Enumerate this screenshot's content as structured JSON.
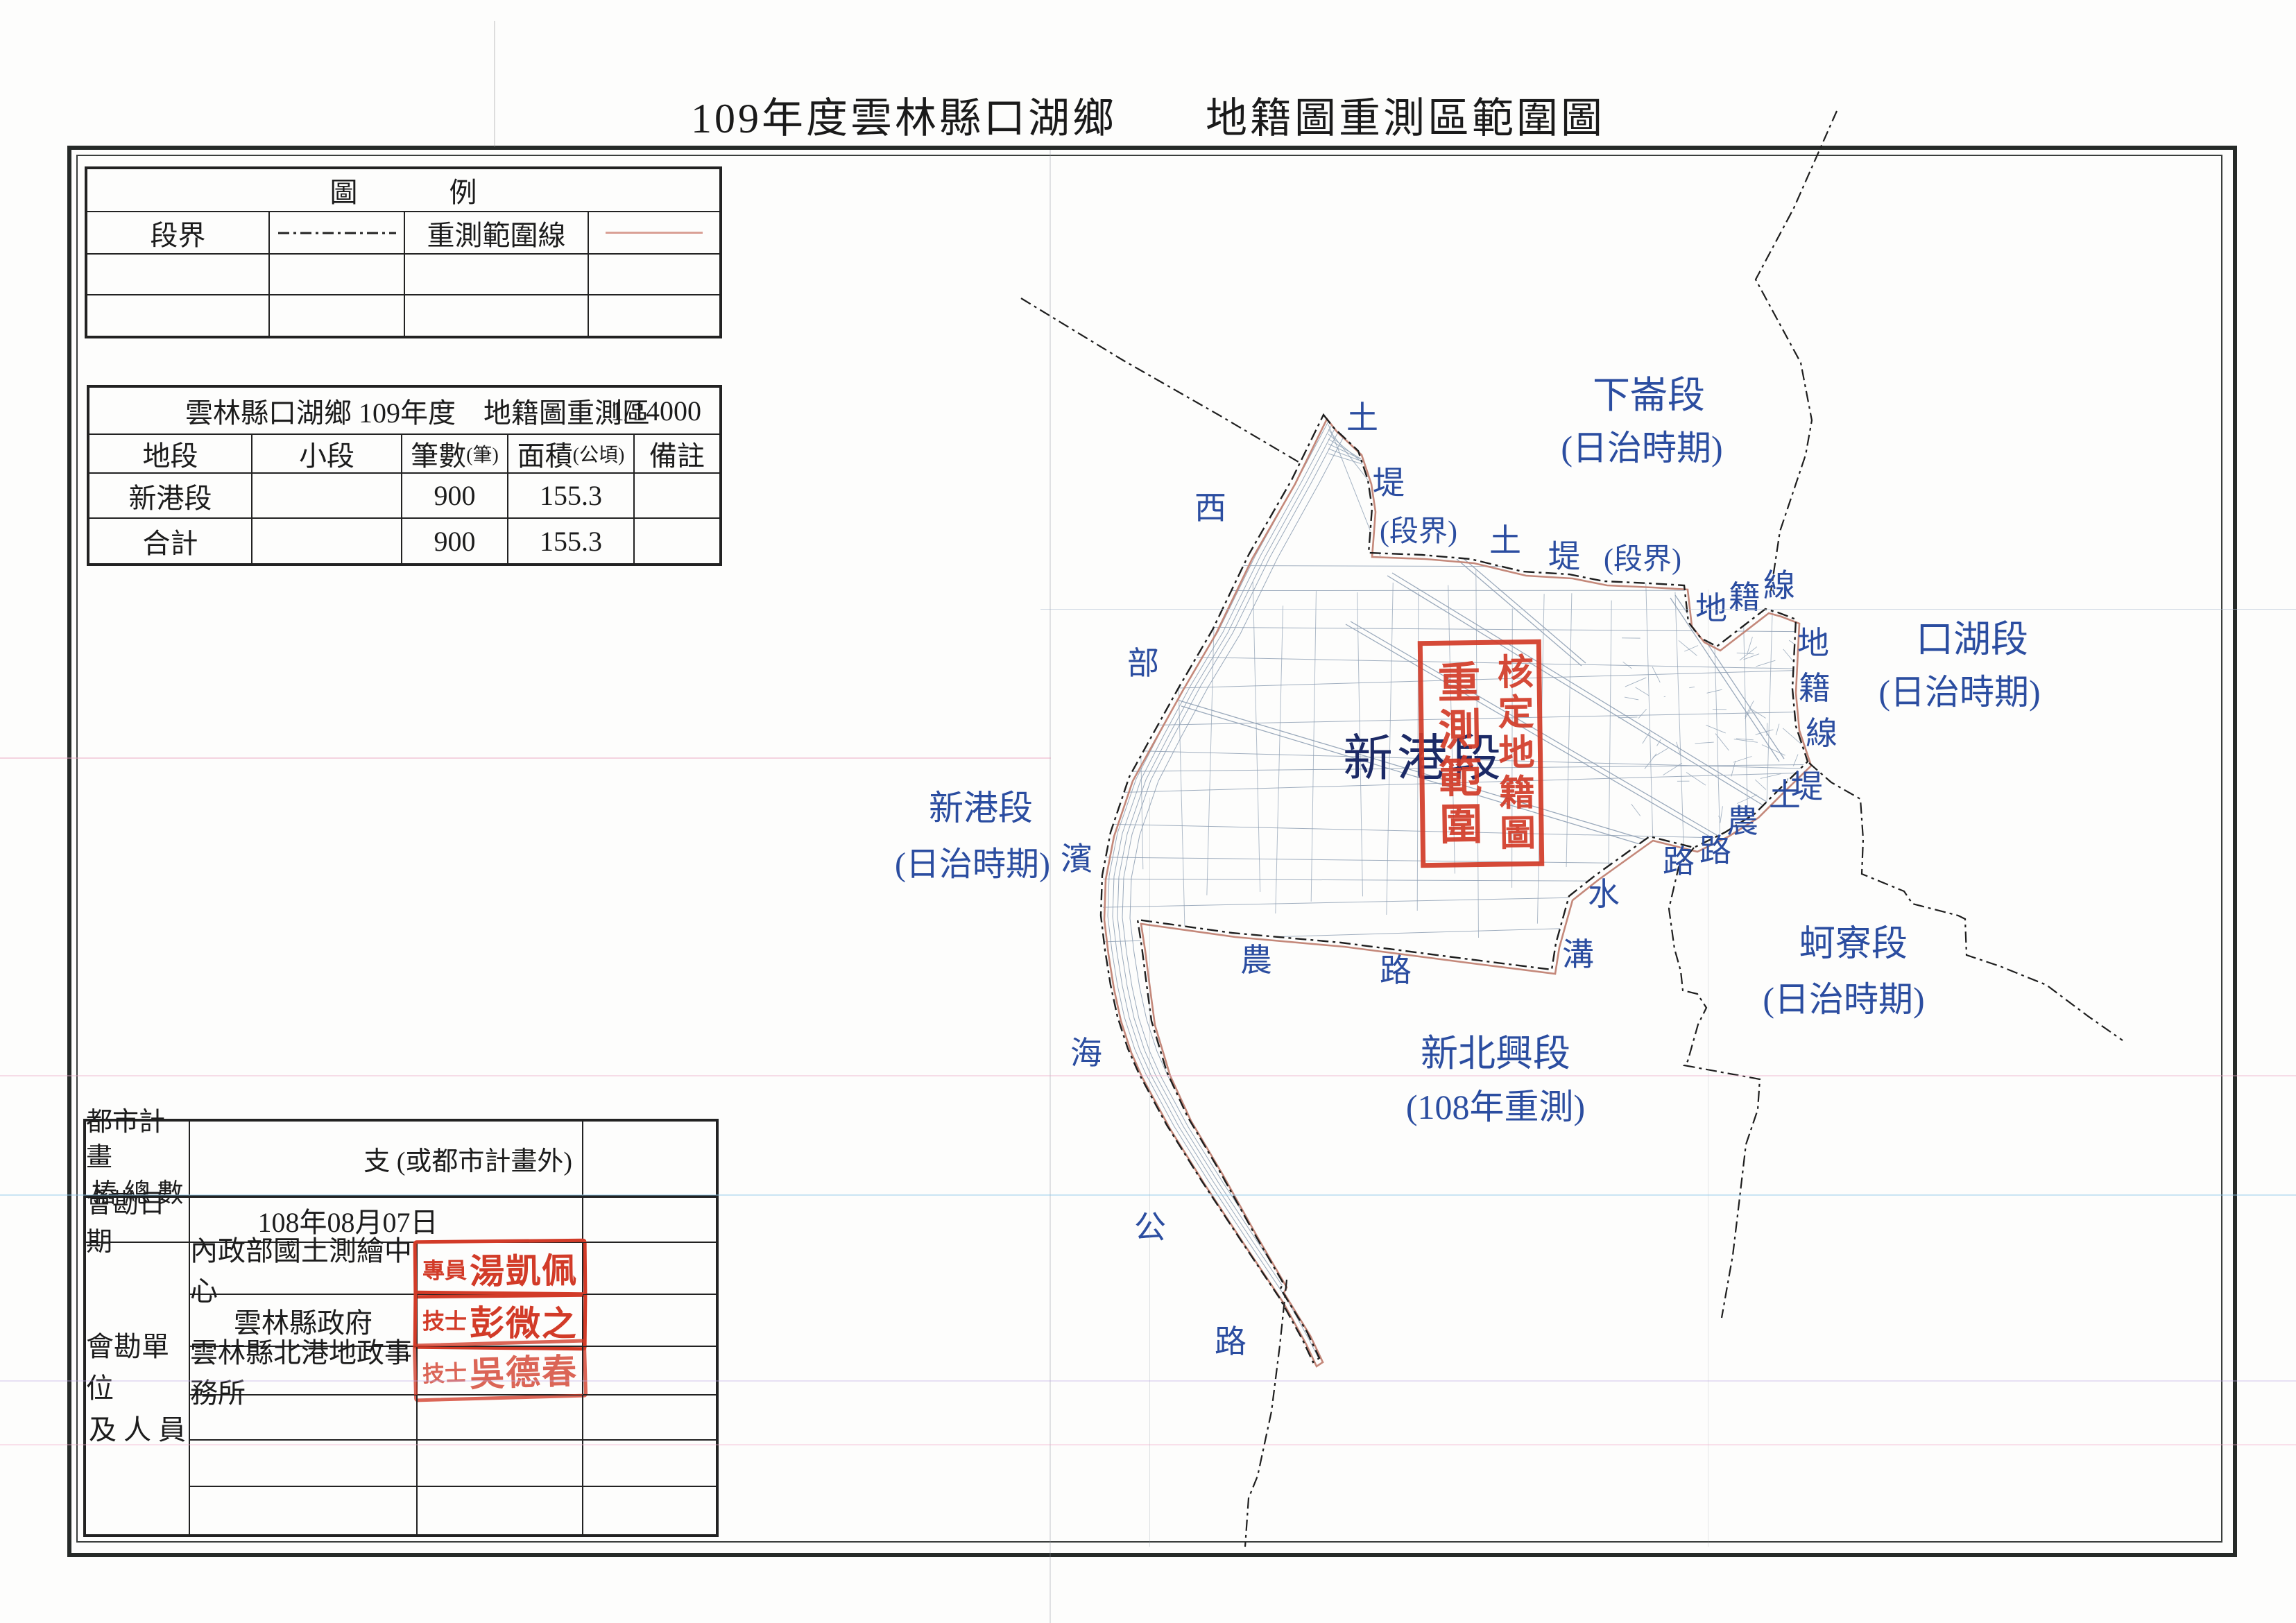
{
  "page": {
    "title": "109年度雲林縣口湖鄉　　地籍圖重測區範圍圖"
  },
  "colors": {
    "label_blue": "#2b4da0",
    "stamp_red": "#d23b28",
    "range_line_pink": "#d9a095",
    "boundary_black": "#1e1e1e"
  },
  "legend": {
    "header": "圖　例",
    "row": {
      "boundary_label": "段界",
      "range_label": "重測範圍線"
    }
  },
  "area_table": {
    "title": "雲林縣口湖鄉 109年度　地籍圖重測區",
    "scale": "1/14000",
    "columns": [
      {
        "label": "地段",
        "unit": ""
      },
      {
        "label": "小段",
        "unit": ""
      },
      {
        "label": "筆數",
        "unit": "(筆)"
      },
      {
        "label": "面積",
        "unit": "(公頃)"
      },
      {
        "label": "備註",
        "unit": ""
      }
    ],
    "rows": [
      {
        "name": "新港段",
        "sub": "",
        "count": "900",
        "area": "155.3",
        "note": ""
      },
      {
        "name": "合計",
        "sub": "",
        "count": "900",
        "area": "155.3",
        "note": ""
      }
    ]
  },
  "survey_table": {
    "piles_label_1": "都市計畫",
    "piles_label_2": "樁 總 數",
    "piles_value": "支 (或都市計畫外)",
    "date_label": "會勘日期",
    "date_value": "108年08月07日",
    "unit_label_1": "會勘單位",
    "unit_label_2": "及 人 員",
    "agencies": [
      {
        "name": "內政部國土測繪中心",
        "stamp_title": "專員",
        "stamp_name": "湯凱佩"
      },
      {
        "name": "雲林縣政府",
        "stamp_title": "技士",
        "stamp_name": "彭微之"
      },
      {
        "name": "雲林縣北港地政事務所",
        "stamp_title": "技士",
        "stamp_name": "吳德春"
      }
    ]
  },
  "map": {
    "stamp": {
      "right_column": "核定地籍圖",
      "left_column": "重測範圍"
    },
    "section_on_map": "新港段",
    "regions": {
      "xialun": {
        "name": "下崙段",
        "era": "(日治時期)"
      },
      "kouhu": {
        "name": "口湖段",
        "era": "(日治時期)"
      },
      "xingang": {
        "name": "新港段",
        "era": "(日治時期)"
      },
      "heliao": {
        "name": "蚵寮段",
        "era": "(日治時期)"
      },
      "xinbeixing": {
        "name": "新北興段",
        "era": "(108年重測)"
      }
    },
    "small_labels": {
      "tu1": "土",
      "ti1": "堤",
      "duanjie1": "(段界)",
      "tu2": "土",
      "ti2": "堤",
      "duanjie2": "(段界)",
      "di1": "地",
      "ji1": "籍",
      "xian1": "線",
      "di2": "地",
      "ji2": "籍",
      "xian2": "線",
      "tu3": "土",
      "ti3": "堤",
      "nong_r": "農",
      "lu_r": "路",
      "lu_r2": "路",
      "nong_b": "農",
      "lu_b": "路",
      "shui": "水",
      "gou": "溝",
      "xi": "西",
      "bu": "部",
      "bin": "濱",
      "hai": "海",
      "gong": "公",
      "lu_road": "路"
    }
  }
}
